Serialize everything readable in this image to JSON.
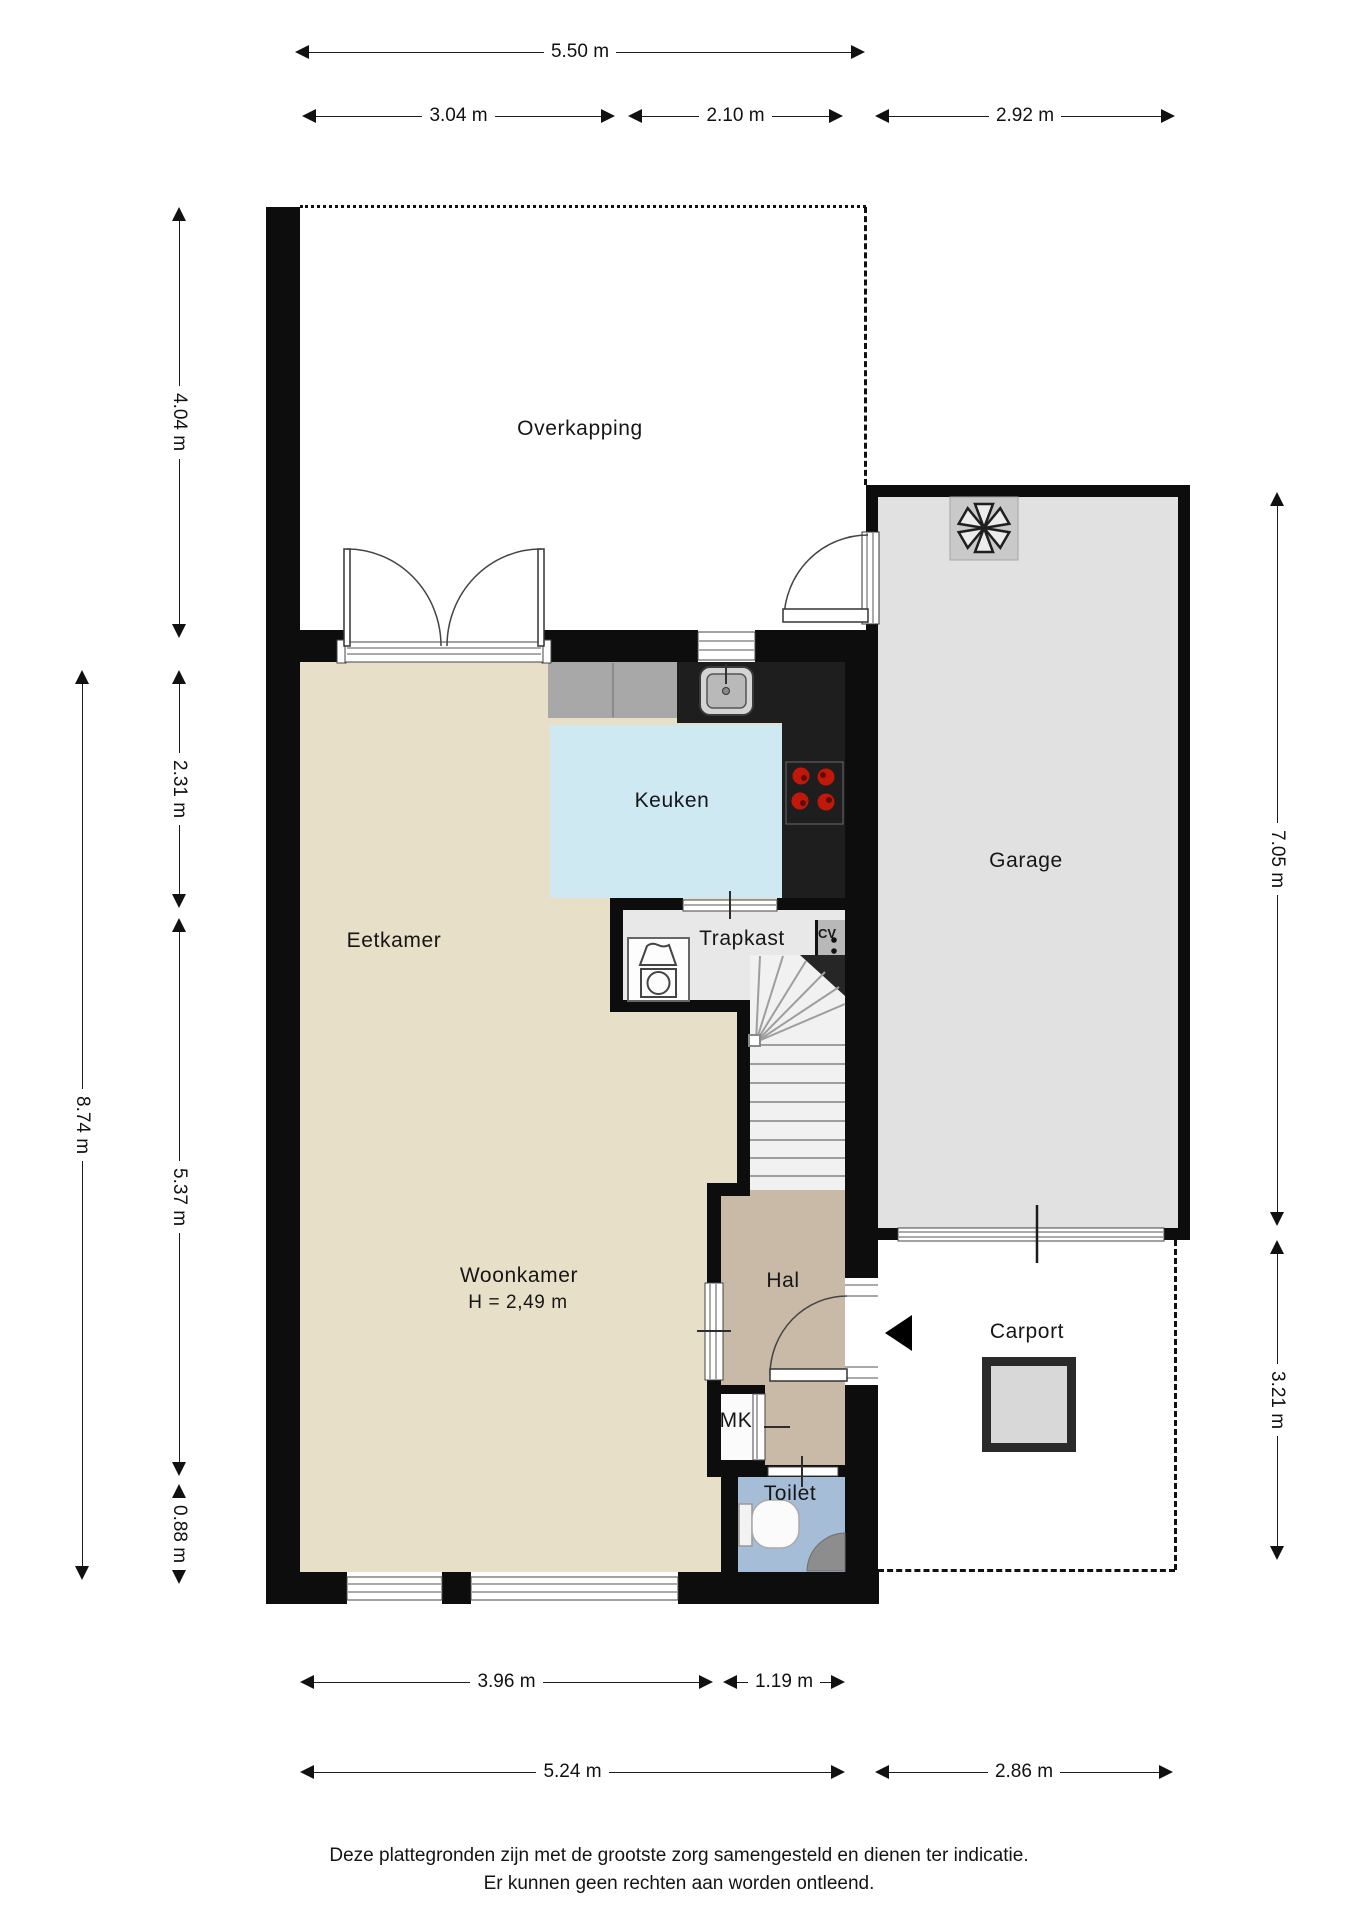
{
  "rooms": {
    "overkapping": "Overkapping",
    "keuken": "Keuken",
    "eetkamer": "Eetkamer",
    "trapkast": "Trapkast",
    "cv": "CV",
    "garage": "Garage",
    "woonkamer": "Woonkamer",
    "woonkamer_height": "H = 2,49 m",
    "hal": "Hal",
    "carport": "Carport",
    "mk": "MK",
    "toilet": "Toilet"
  },
  "dimensions": {
    "top_total": "5.50 m",
    "top_left": "3.04 m",
    "top_mid": "2.10 m",
    "top_garage": "2.92 m",
    "left_overkapping": "4.04 m",
    "left_keuken": "2.31 m",
    "left_woonkamer": "5.37 m",
    "left_toilet": "0.88 m",
    "left_total": "8.74 m",
    "right_garage": "7.05 m",
    "right_carport": "3.21 m",
    "bottom_woonkamer": "3.96 m",
    "bottom_hal": "1.19 m",
    "bottom_total": "5.24 m",
    "bottom_carport": "2.86 m"
  },
  "disclaimer": {
    "line1": "Deze plattegronden zijn met de grootste zorg samengesteld en dienen ter indicatie.",
    "line2": "Er kunnen geen rechten aan worden ontleend."
  },
  "colors": {
    "wall": "#0d0d0d",
    "floor_main": "#e7dfc7",
    "floor_kitchen": "#cfe9f2",
    "floor_hal": "#c8baa7",
    "floor_toilet": "#a6bdd8",
    "floor_garage": "#e1e1e1",
    "floor_trapkast": "#e8e8e8",
    "floor_stairs": "#f1f1f1",
    "counter": "#1e1e1e",
    "cabinet": "#a8a8a8",
    "burner": "#c2180b",
    "dimline": "#1c1c1c"
  }
}
